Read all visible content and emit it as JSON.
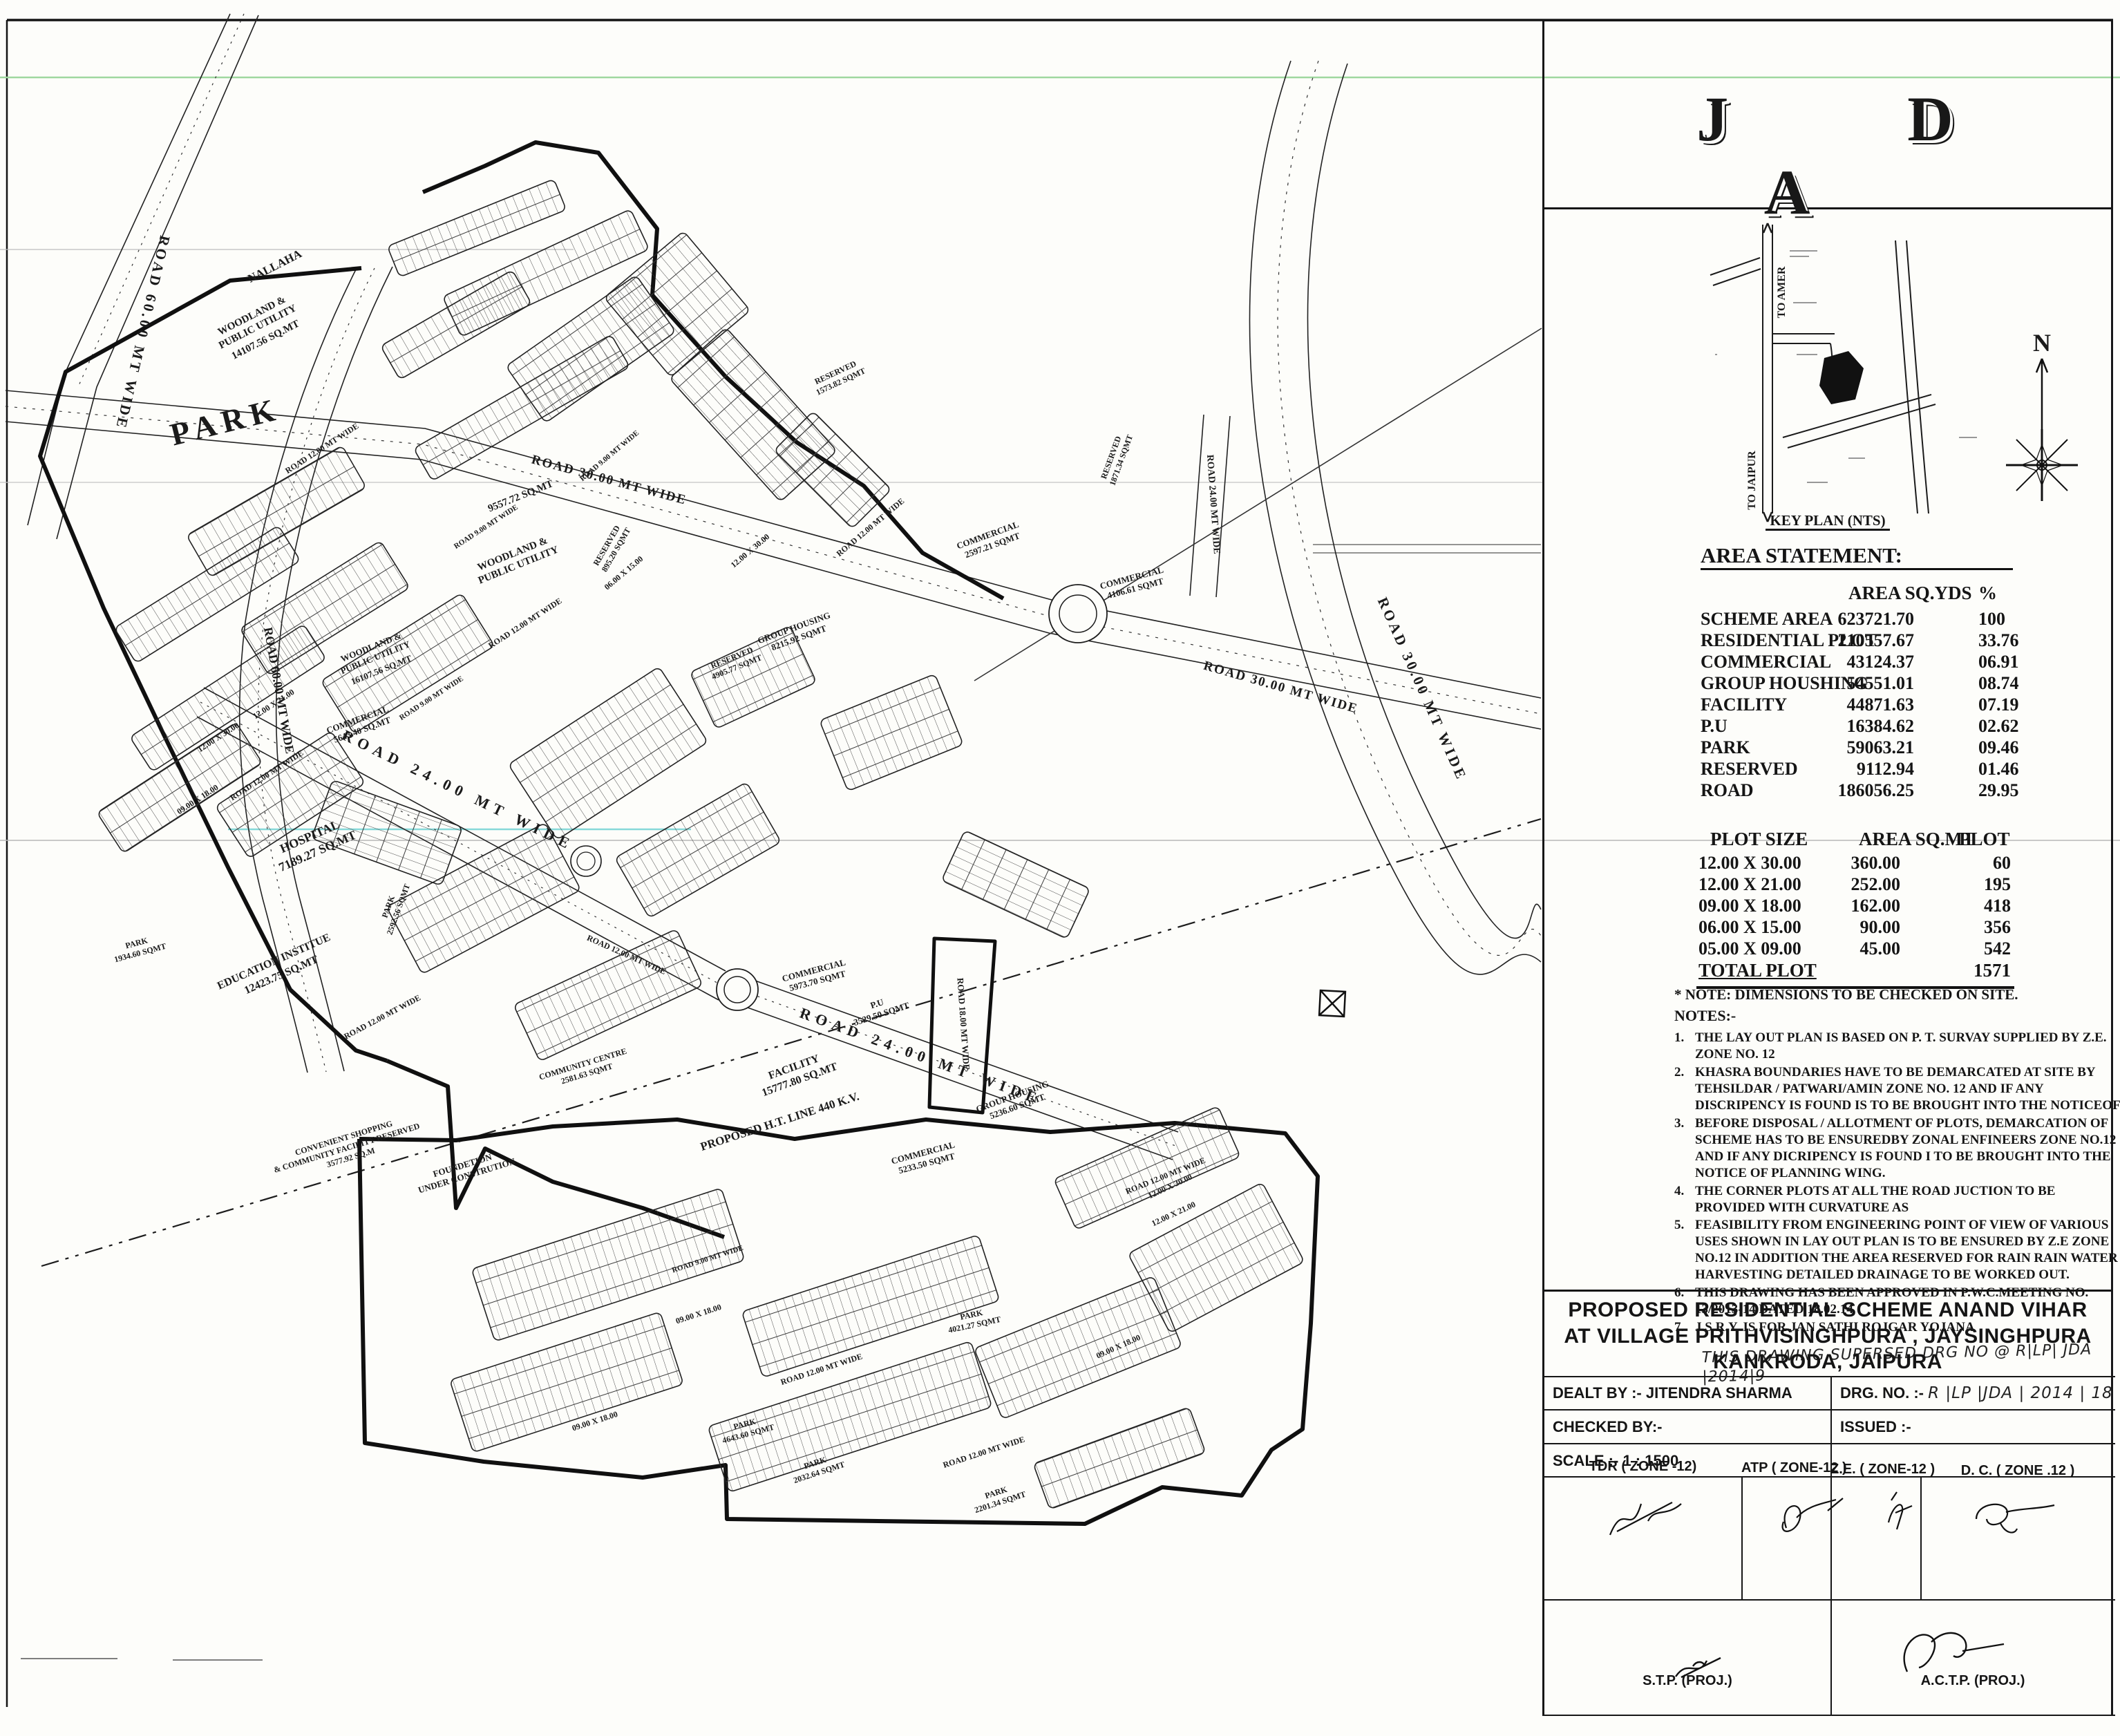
{
  "sheet_title": "PROPOSED RESIDENTIAL SCHEME ANAND VIHAR",
  "map": {
    "roads": {
      "r60": "ROAD 60.00 MT WIDE",
      "r30": "ROAD 30.00 MT WIDE",
      "r24": "ROAD 24.00 MT WIDE",
      "r18": "ROAD 18.00 MT WIDE",
      "r12": "ROAD 12.00 MT WIDE",
      "r9": "ROAD 9.00 MT WIDE",
      "ht_line": "PROPOSED H.T. LINE 440 K.V."
    },
    "dims": {
      "d1": "12.00 X 30.00",
      "d2": "12.00 X 21.00",
      "d3": "09.00 X 18.00",
      "d4": "06.00 X 15.00"
    },
    "areas": {
      "park_big": "PARK",
      "nallaha": "NALLAHA",
      "woodland1": {
        "l1": "WOODLAND &",
        "l2": "PUBLIC UTILITY",
        "area": "14107.56 SQ.MT"
      },
      "woodland2": {
        "l1": "WOODLAND &",
        "l2": "PUBLIC UTILITY",
        "area": "9557.72 SQ.MT"
      },
      "woodland3": {
        "l1": "WOODLAND &",
        "l2": "PUBLIC UTILITY",
        "area": "16107.56 SQ.MT"
      },
      "hospital": {
        "name": "HOSPITAL",
        "area": "7189.27 SQ.MT"
      },
      "education": {
        "name": "EDUCATION INSTITUE",
        "area": "12423.75 SQ.MT"
      },
      "comm1": {
        "name": "COMMERCIAL",
        "area": "5643.40 SQ.MT"
      },
      "comm2": {
        "name": "COMMERCIAL",
        "area": "2597.21 SQMT"
      },
      "comm3": {
        "name": "COMMERCIAL",
        "area": "4106.61 SQMT"
      },
      "comm4": {
        "name": "COMMERCIAL",
        "area": "5973.70 SQMT"
      },
      "comm5": {
        "name": "COMMERCIAL",
        "area": "5233.50 SQMT"
      },
      "pu": {
        "name": "P.U",
        "area": "3529.50 SQMT"
      },
      "gh1": {
        "name": "GROUP HOUSING",
        "area": "8215.92 SQMT"
      },
      "gh2": {
        "name": "GROUP HOUSING",
        "area": "5236.60 SQMT"
      },
      "facility": {
        "name": "FACILITY",
        "area": "15777.80 SQ.MT"
      },
      "res1": {
        "name": "RESERVED",
        "area": "1573.82 SQMT"
      },
      "res2": {
        "name": "RESERVED",
        "area": "895.20 SQMT"
      },
      "res3": {
        "name": "RESERVED",
        "area": "4905.77 SQMT"
      },
      "res4": {
        "name": "RESERVED",
        "area": "1871.34 SQMT"
      },
      "park1": {
        "name": "PARK",
        "area": "4021.27 SQMT"
      },
      "park2": {
        "name": "PARK",
        "area": "4643.60 SQMT"
      },
      "park3": {
        "name": "PARK",
        "area": "2032.64 SQMT"
      },
      "park4": {
        "name": "PARK",
        "area": "2201.34 SQMT"
      },
      "park5": {
        "name": "PARK",
        "area": "2592.56 SQMT"
      },
      "park6": {
        "name": "PARK",
        "area": "1934.60 SQMT"
      },
      "cc": {
        "name": "COMMUNITY CENTRE",
        "area": "2581.63 SQMT"
      },
      "conv": {
        "l1": "CONVENIENT SHOPPING",
        "l2": "& COMMUNITY FACILITY RESERVED",
        "l3": "3577.92 SQ.M"
      },
      "foundation": {
        "l1": "FOUNDETION",
        "l2": "UNDER CONSTRUTION"
      }
    }
  },
  "panel": {
    "logo": "J D A",
    "key_plan": {
      "to_amer": "TO AMER",
      "to_jaipur": "TO JAIPUR",
      "caption": "KEY PLAN (NTS)",
      "north": "N"
    },
    "area_statement": {
      "title": "AREA STATEMENT:",
      "col_area": "AREA SQ.YDS",
      "col_pct": "%",
      "rows": [
        {
          "label": "SCHEME AREA",
          "area": "623721.70",
          "pct": "100"
        },
        {
          "label": "RESIDENTIAL PLOT",
          "area": "210557.67",
          "pct": "33.76"
        },
        {
          "label": "COMMERCIAL",
          "area": "43124.37",
          "pct": "06.91"
        },
        {
          "label": "GROUP HOUSHING",
          "area": "54551.01",
          "pct": "08.74"
        },
        {
          "label": "FACILITY",
          "area": "44871.63",
          "pct": "07.19"
        },
        {
          "label": "P.U",
          "area": "16384.62",
          "pct": "02.62"
        },
        {
          "label": "PARK",
          "area": "59063.21",
          "pct": "09.46"
        },
        {
          "label": "RESERVED",
          "area": "9112.94",
          "pct": "01.46"
        },
        {
          "label": "ROAD",
          "area": "186056.25",
          "pct": "29.95"
        }
      ]
    },
    "plot_table": {
      "col_size": "PLOT SIZE",
      "col_area": "AREA SQ.MT",
      "col_plot": "PLOT",
      "rows": [
        {
          "size": "12.00 X 30.00",
          "area": "360.00",
          "plot": "60"
        },
        {
          "size": "12.00 X 21.00",
          "area": "252.00",
          "plot": "195"
        },
        {
          "size": "09.00 X 18.00",
          "area": "162.00",
          "plot": "418"
        },
        {
          "size": "06.00 X 15.00",
          "area": "90.00",
          "plot": "356"
        },
        {
          "size": "05.00 X 09.00",
          "area": "45.00",
          "plot": "542"
        }
      ],
      "total_label": "TOTAL PLOT",
      "total_plot": "1571"
    },
    "notes": {
      "star": "* NOTE: DIMENSIONS TO BE CHECKED ON SITE.",
      "head": "NOTES:-",
      "items": [
        "THE LAY OUT PLAN IS BASED ON  P. T. SURVAY SUPPLIED BY Z.E. ZONE NO. 12",
        "KHASRA  BOUNDARIES HAVE TO BE DEMARCATED AT SITE BY TEHSILDAR / PATWARI/AMIN ZONE NO. 12 AND IF ANY DISCRIPENCY IS FOUND IS TO BE BROUGHT INTO THE NOTICEOF",
        "BEFORE DISPOSAL / ALLOTMENT OF PLOTS, DEMARCATION OF SCHEME HAS TO BE ENSUREDBY ZONAL ENFINEERS ZONE NO.12  AND IF ANY DICRIPENCY IS FOUND I TO BE BROUGHT INTO  THE NOTICE OF PLANNING WING.",
        "THE CORNER PLOTS AT ALL  THE ROAD JUCTION TO BE PROVIDED WITH CURVATURE AS",
        "FEASIBILITY FROM ENGINEERING POINT OF VIEW OF VARIOUS USES SHOWN IN LAY OUT PLAN IS TO BE ENSURED BY Z.E ZONE NO.12  IN ADDITION THE AREA RESERVED FOR RAIN  RAIN WATER HARVESTING DETAILED DRAINAGE TO BE WORKED OUT.",
        "THIS DRAWING HAS BEEN APPROVED IN P.W.C.MEETING NO. 13/2013-14 DATED 18.02.14",
        "J.S.R.Y. IS FOR JAN SATHI ROJGAR  YOJANA"
      ],
      "handwritten": "THIS DRAWING SUPERSED DRG NO @ R|LP| JDA |2014|9"
    },
    "title_block": {
      "line1": "PROPOSED RESIDENTIAL SCHEME ANAND VIHAR",
      "line2": "AT VILLAGE PRITHVISINGHPURA , JAYSINGHPURA",
      "line3": "KANKRODA, JAIPURA",
      "dealt_label": "DEALT BY  :-",
      "dealt_value": "JITENDRA SHARMA",
      "drg_label": "DRG. NO. :-",
      "drg_value": "R |LP |JDA | 2014 | 18",
      "checked_label": "CHECKED BY:-",
      "issued_label": "ISSUED :-",
      "scale_label": "SCALE :-",
      "scale_value": "1 : 1500"
    },
    "signatures": {
      "s1": "TDR ( ZONE -12)",
      "s2": "ATP ( ZONE-12 )",
      "s3": "Z.E. ( ZONE-12 )",
      "s4": "D. C. ( ZONE .12 )",
      "s5": "S.T.P. (PROJ.)",
      "s6": "A.C.T.P. (PROJ.)"
    }
  }
}
